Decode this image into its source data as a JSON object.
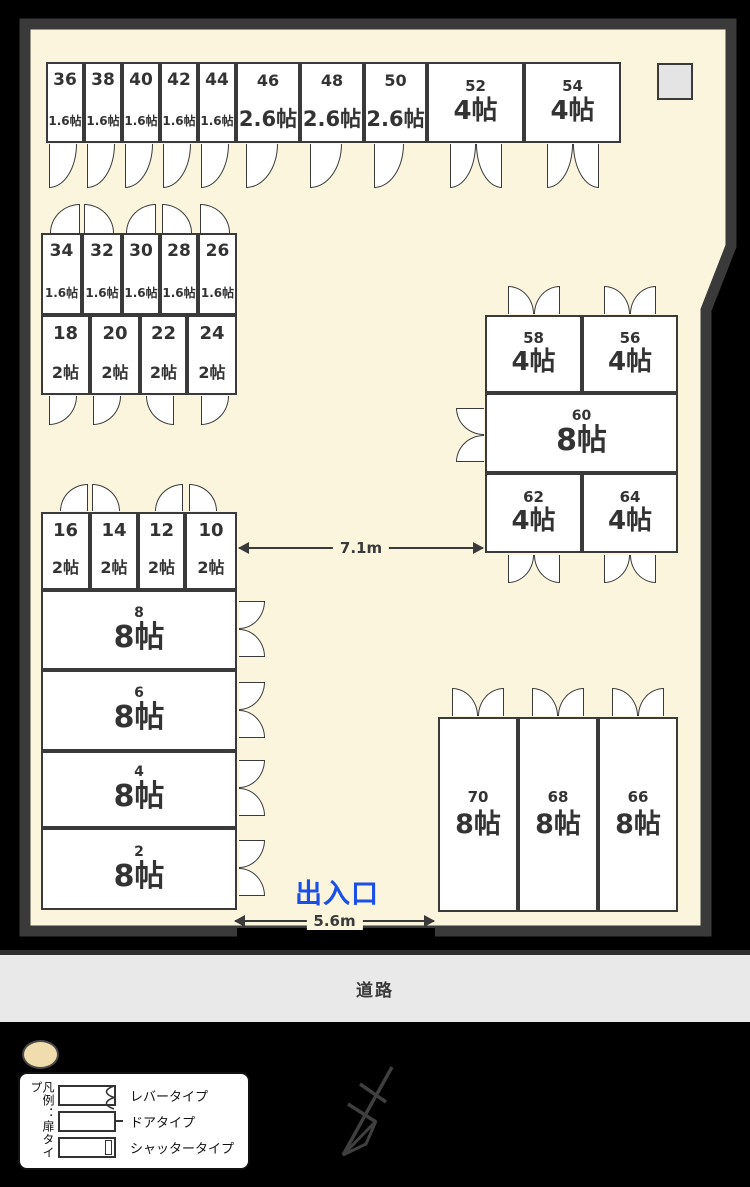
{
  "facility": {
    "entrance_label": "出入口",
    "road_label": "道路",
    "colors": {
      "background": "#000000",
      "wall": "#3a3a3a",
      "floor": "#faf5dc",
      "unit_fill": "#ffffff",
      "unit_border": "#3a3a3a",
      "unit_text": "#333333",
      "entrance_text": "#1a50e6",
      "road_fill": "#e9e9e9",
      "pillar_fill": "#e4e4e4",
      "marker_fill": "#f1dcae"
    }
  },
  "measurements": [
    {
      "label": "7.1m",
      "x1": 239,
      "x2": 483,
      "y": 540
    },
    {
      "label": "5.6m",
      "x1": 235,
      "x2": 434,
      "y": 913
    }
  ],
  "entrance": {
    "x": 295,
    "y": 872
  },
  "pillar": {
    "x": 657,
    "y": 63,
    "w": 36,
    "h": 37
  },
  "marker_ellipse": {
    "x": 22,
    "y": 1040,
    "w": 37,
    "h": 29
  },
  "units": [
    {
      "id": "36",
      "size": "1.6帖",
      "x": 46,
      "y": 62,
      "w": 38,
      "h": 81,
      "cls": "s"
    },
    {
      "id": "38",
      "size": "1.6帖",
      "x": 84,
      "y": 62,
      "w": 38,
      "h": 81,
      "cls": "s"
    },
    {
      "id": "40",
      "size": "1.6帖",
      "x": 122,
      "y": 62,
      "w": 38,
      "h": 81,
      "cls": "s"
    },
    {
      "id": "42",
      "size": "1.6帖",
      "x": 160,
      "y": 62,
      "w": 38,
      "h": 81,
      "cls": "s"
    },
    {
      "id": "44",
      "size": "1.6帖",
      "x": 198,
      "y": 62,
      "w": 38,
      "h": 81,
      "cls": "s"
    },
    {
      "id": "46",
      "size": "2.6帖",
      "x": 236,
      "y": 62,
      "w": 64,
      "h": 81,
      "cls": "l"
    },
    {
      "id": "48",
      "size": "2.6帖",
      "x": 300,
      "y": 62,
      "w": 64,
      "h": 81,
      "cls": "l"
    },
    {
      "id": "50",
      "size": "2.6帖",
      "x": 364,
      "y": 62,
      "w": 63,
      "h": 81,
      "cls": "l"
    },
    {
      "id": "52",
      "size": "4帖",
      "x": 427,
      "y": 62,
      "w": 97,
      "h": 81,
      "cls": "xl"
    },
    {
      "id": "54",
      "size": "4帖",
      "x": 524,
      "y": 62,
      "w": 97,
      "h": 81,
      "cls": "xl"
    },
    {
      "id": "34",
      "size": "1.6帖",
      "x": 41,
      "y": 233,
      "w": 41,
      "h": 82,
      "cls": "s"
    },
    {
      "id": "32",
      "size": "1.6帖",
      "x": 82,
      "y": 233,
      "w": 40,
      "h": 82,
      "cls": "s"
    },
    {
      "id": "30",
      "size": "1.6帖",
      "x": 122,
      "y": 233,
      "w": 38,
      "h": 82,
      "cls": "s"
    },
    {
      "id": "28",
      "size": "1.6帖",
      "x": 160,
      "y": 233,
      "w": 38,
      "h": 82,
      "cls": "s"
    },
    {
      "id": "26",
      "size": "1.6帖",
      "x": 198,
      "y": 233,
      "w": 39,
      "h": 82,
      "cls": "s"
    },
    {
      "id": "18",
      "size": "2帖",
      "x": 41,
      "y": 315,
      "w": 49,
      "h": 80,
      "cls": "m"
    },
    {
      "id": "20",
      "size": "2帖",
      "x": 90,
      "y": 315,
      "w": 50,
      "h": 80,
      "cls": "m"
    },
    {
      "id": "22",
      "size": "2帖",
      "x": 140,
      "y": 315,
      "w": 47,
      "h": 80,
      "cls": "m"
    },
    {
      "id": "24",
      "size": "2帖",
      "x": 187,
      "y": 315,
      "w": 50,
      "h": 80,
      "cls": "m"
    },
    {
      "id": "58",
      "size": "4帖",
      "x": 485,
      "y": 315,
      "w": 97,
      "h": 78,
      "cls": "xl"
    },
    {
      "id": "56",
      "size": "4帖",
      "x": 582,
      "y": 315,
      "w": 96,
      "h": 78,
      "cls": "xl"
    },
    {
      "id": "60",
      "size": "8帖",
      "x": 485,
      "y": 393,
      "w": 193,
      "h": 80,
      "cls": "xxl"
    },
    {
      "id": "62",
      "size": "4帖",
      "x": 485,
      "y": 473,
      "w": 97,
      "h": 80,
      "cls": "xl"
    },
    {
      "id": "64",
      "size": "4帖",
      "x": 582,
      "y": 473,
      "w": 96,
      "h": 80,
      "cls": "xl"
    },
    {
      "id": "16",
      "size": "2帖",
      "x": 41,
      "y": 512,
      "w": 49,
      "h": 78,
      "cls": "m"
    },
    {
      "id": "14",
      "size": "2帖",
      "x": 90,
      "y": 512,
      "w": 48,
      "h": 78,
      "cls": "m"
    },
    {
      "id": "12",
      "size": "2帖",
      "x": 138,
      "y": 512,
      "w": 47,
      "h": 78,
      "cls": "m"
    },
    {
      "id": "10",
      "size": "2帖",
      "x": 185,
      "y": 512,
      "w": 52,
      "h": 78,
      "cls": "m"
    },
    {
      "id": "8",
      "size": "8帖",
      "x": 41,
      "y": 590,
      "w": 196,
      "h": 80,
      "cls": "xxl"
    },
    {
      "id": "6",
      "size": "8帖",
      "x": 41,
      "y": 670,
      "w": 196,
      "h": 81,
      "cls": "xxl"
    },
    {
      "id": "4",
      "size": "8帖",
      "x": 41,
      "y": 751,
      "w": 196,
      "h": 77,
      "cls": "xxl"
    },
    {
      "id": "2",
      "size": "8帖",
      "x": 41,
      "y": 828,
      "w": 196,
      "h": 82,
      "cls": "xxl"
    },
    {
      "id": "70",
      "size": "8帖",
      "x": 438,
      "y": 717,
      "w": 80,
      "h": 195,
      "cls": "tall"
    },
    {
      "id": "68",
      "size": "8帖",
      "x": 518,
      "y": 717,
      "w": 80,
      "h": 195,
      "cls": "tall"
    },
    {
      "id": "66",
      "size": "8帖",
      "x": 598,
      "y": 717,
      "w": 80,
      "h": 195,
      "cls": "tall"
    }
  ],
  "doors": [
    {
      "x": 49,
      "y": 144,
      "w": 28,
      "h": 44,
      "k": "dl"
    },
    {
      "x": 87,
      "y": 144,
      "w": 28,
      "h": 44,
      "k": "dl"
    },
    {
      "x": 125,
      "y": 144,
      "w": 28,
      "h": 44,
      "k": "dl"
    },
    {
      "x": 163,
      "y": 144,
      "w": 28,
      "h": 44,
      "k": "dl"
    },
    {
      "x": 201,
      "y": 144,
      "w": 28,
      "h": 44,
      "k": "dl"
    },
    {
      "x": 246,
      "y": 144,
      "w": 32,
      "h": 44,
      "k": "dl"
    },
    {
      "x": 310,
      "y": 144,
      "w": 32,
      "h": 44,
      "k": "dl"
    },
    {
      "x": 374,
      "y": 144,
      "w": 30,
      "h": 44,
      "k": "dl"
    },
    {
      "x": 450,
      "y": 144,
      "w": 26,
      "h": 44,
      "k": "dl"
    },
    {
      "x": 476,
      "y": 144,
      "w": 26,
      "h": 44,
      "k": "dr"
    },
    {
      "x": 547,
      "y": 144,
      "w": 26,
      "h": 44,
      "k": "dl"
    },
    {
      "x": 573,
      "y": 144,
      "w": 26,
      "h": 44,
      "k": "dr"
    },
    {
      "x": 50,
      "y": 204,
      "w": 30,
      "h": 29,
      "k": "ur"
    },
    {
      "x": 84,
      "y": 204,
      "w": 30,
      "h": 29,
      "k": "ul"
    },
    {
      "x": 126,
      "y": 204,
      "w": 30,
      "h": 29,
      "k": "ur"
    },
    {
      "x": 162,
      "y": 204,
      "w": 30,
      "h": 29,
      "k": "ul"
    },
    {
      "x": 200,
      "y": 204,
      "w": 30,
      "h": 29,
      "k": "ul"
    },
    {
      "x": 49,
      "y": 396,
      "w": 28,
      "h": 29,
      "k": "dl"
    },
    {
      "x": 93,
      "y": 396,
      "w": 28,
      "h": 29,
      "k": "dl"
    },
    {
      "x": 146,
      "y": 396,
      "w": 28,
      "h": 29,
      "k": "dr"
    },
    {
      "x": 201,
      "y": 396,
      "w": 28,
      "h": 29,
      "k": "dl"
    },
    {
      "x": 508,
      "y": 286,
      "w": 26,
      "h": 28,
      "k": "ul"
    },
    {
      "x": 534,
      "y": 286,
      "w": 26,
      "h": 28,
      "k": "ur"
    },
    {
      "x": 604,
      "y": 286,
      "w": 26,
      "h": 28,
      "k": "ul"
    },
    {
      "x": 630,
      "y": 286,
      "w": 26,
      "h": 28,
      "k": "ur"
    },
    {
      "x": 456,
      "y": 408,
      "w": 28,
      "h": 27,
      "k": "lu"
    },
    {
      "x": 456,
      "y": 435,
      "w": 28,
      "h": 27,
      "k": "ld"
    },
    {
      "x": 508,
      "y": 555,
      "w": 26,
      "h": 28,
      "k": "dl"
    },
    {
      "x": 534,
      "y": 555,
      "w": 26,
      "h": 28,
      "k": "dr"
    },
    {
      "x": 604,
      "y": 555,
      "w": 26,
      "h": 28,
      "k": "dl"
    },
    {
      "x": 630,
      "y": 555,
      "w": 26,
      "h": 28,
      "k": "dr"
    },
    {
      "x": 60,
      "y": 484,
      "w": 28,
      "h": 27,
      "k": "ur"
    },
    {
      "x": 92,
      "y": 484,
      "w": 28,
      "h": 27,
      "k": "ul"
    },
    {
      "x": 155,
      "y": 484,
      "w": 28,
      "h": 27,
      "k": "ur"
    },
    {
      "x": 189,
      "y": 484,
      "w": 28,
      "h": 27,
      "k": "ul"
    },
    {
      "x": 239,
      "y": 601,
      "w": 26,
      "h": 28,
      "k": "ru"
    },
    {
      "x": 239,
      "y": 629,
      "w": 26,
      "h": 28,
      "k": "rd"
    },
    {
      "x": 239,
      "y": 682,
      "w": 26,
      "h": 28,
      "k": "ru"
    },
    {
      "x": 239,
      "y": 710,
      "w": 26,
      "h": 28,
      "k": "rd"
    },
    {
      "x": 239,
      "y": 760,
      "w": 26,
      "h": 28,
      "k": "ru"
    },
    {
      "x": 239,
      "y": 788,
      "w": 26,
      "h": 28,
      "k": "rd"
    },
    {
      "x": 239,
      "y": 840,
      "w": 26,
      "h": 28,
      "k": "ru"
    },
    {
      "x": 239,
      "y": 868,
      "w": 26,
      "h": 28,
      "k": "rd"
    },
    {
      "x": 452,
      "y": 688,
      "w": 26,
      "h": 28,
      "k": "ul"
    },
    {
      "x": 478,
      "y": 688,
      "w": 26,
      "h": 28,
      "k": "ur"
    },
    {
      "x": 532,
      "y": 688,
      "w": 26,
      "h": 28,
      "k": "ul"
    },
    {
      "x": 558,
      "y": 688,
      "w": 26,
      "h": 28,
      "k": "ur"
    },
    {
      "x": 612,
      "y": 688,
      "w": 26,
      "h": 28,
      "k": "ul"
    },
    {
      "x": 638,
      "y": 688,
      "w": 26,
      "h": 28,
      "k": "ur"
    }
  ],
  "legend": {
    "title": "凡例：扉タイプ",
    "items": [
      {
        "label": "レバータイプ",
        "symbol": "lever"
      },
      {
        "label": "ドアタイプ",
        "symbol": "door"
      },
      {
        "label": "シャッタータイプ",
        "symbol": "shutter"
      }
    ]
  }
}
